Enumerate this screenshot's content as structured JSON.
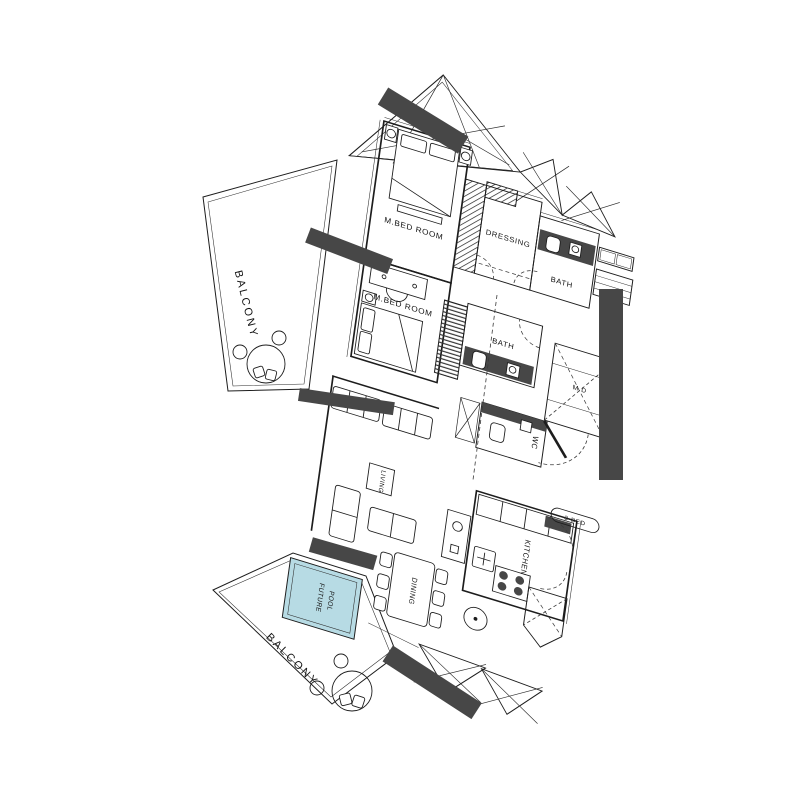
{
  "labels": {
    "unit_type": "3-BED",
    "master_bedroom_1": "M.BED ROOM",
    "master_bedroom_2": "M.BED ROOM",
    "dressing": "DRESSING",
    "bath_1": "BATH",
    "bath_2": "BATH",
    "wc": "WC",
    "main_door": "M.D",
    "living": "LIVING",
    "kitchen": "KITCHEN",
    "dining": "DINING",
    "balcony_upper": "BALCONY",
    "balcony_lower": "BALCONY",
    "future_pool_line_1": "FUTURE",
    "future_pool_line_2": "POOL"
  },
  "colors": {
    "pool_fill": "#b7dbe4",
    "structure_dark": "#474747",
    "line": "#1d1d1d",
    "background": "#ffffff"
  }
}
